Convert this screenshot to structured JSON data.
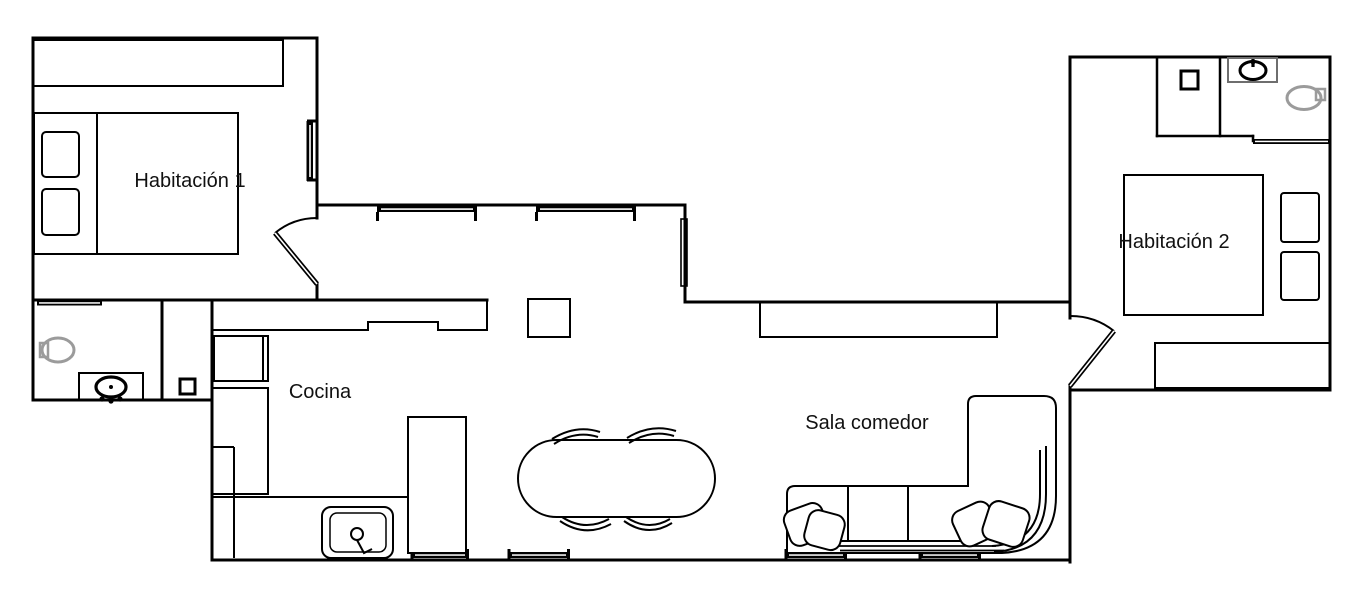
{
  "floor_plan": {
    "type": "apartment-floor-plan",
    "rooms": [
      {
        "id": "habitacion-1",
        "label": "Habitación 1"
      },
      {
        "id": "cocina",
        "label": "Cocina"
      },
      {
        "id": "sala-comedor",
        "label": "Sala comedor"
      },
      {
        "id": "habitacion-2",
        "label": "Habitación 2"
      }
    ],
    "fixtures": [
      "double-bed",
      "bed-pillow",
      "wardrobe",
      "window",
      "door-swing",
      "sliding-door",
      "toilet",
      "washbasin",
      "vanity-cabinet",
      "shower-unit",
      "water-heater",
      "kitchen-counter",
      "kitchen-cabinet",
      "kitchen-sink",
      "faucet",
      "refrigerator",
      "dining-table",
      "dining-chair",
      "side-table",
      "sideboard",
      "corner-sofa",
      "sofa-cushion",
      "dresser"
    ],
    "colors": {
      "wall_line": "#000000",
      "fixture_line": "#000000",
      "sanitary_gray": "#9b9b9b",
      "text": "#111111",
      "background": "#ffffff"
    }
  }
}
